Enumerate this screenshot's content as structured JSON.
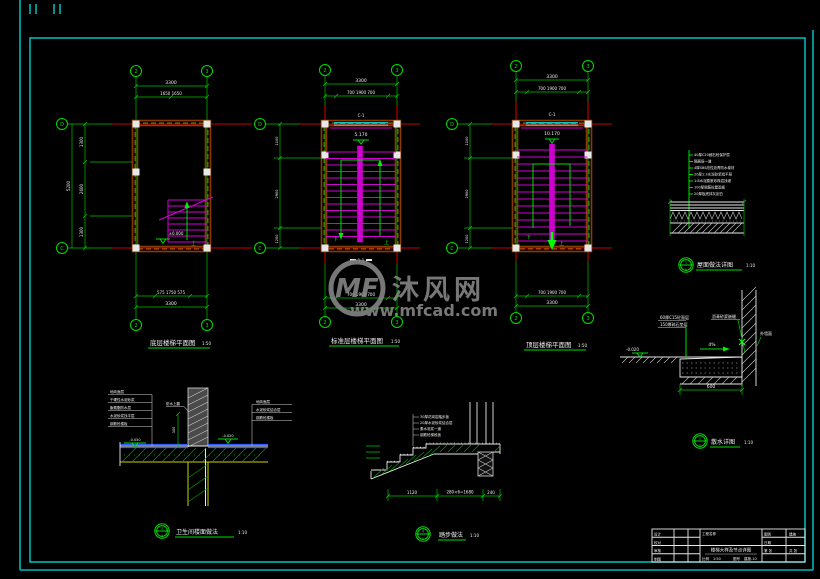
{
  "frame": {
    "border_color": "#00b7b7"
  },
  "watermark": {
    "logo_text": "MF",
    "brand": "沐风网",
    "url": "www.mfcad.com"
  },
  "axis_bubbles": {
    "top": [
      "2",
      "3"
    ],
    "side": [
      "D",
      "C"
    ]
  },
  "plans": [
    {
      "title": "底层楼梯平面图",
      "scale": "1:50",
      "dim_top_1": "3300",
      "dim_top_2": "1650  1650",
      "dim_bottom_1": "575 1750 575",
      "dim_bottom_2": "3300",
      "dim_left": [
        "1300",
        "2600",
        "1300"
      ],
      "dim_left_overall": "5200",
      "elevation": "±0.000",
      "arrow_up": "上"
    },
    {
      "title": "标准层楼梯平面图",
      "scale": "1:50",
      "window": "C-1",
      "elevation": "5.170",
      "dim_top_1": "3300",
      "dim_top_2": "700 1900 700",
      "dim_bottom_1": "700 1900 700",
      "dim_bottom_2": "3300",
      "dim_left": [
        "1100",
        "2900",
        "1200"
      ],
      "arrow_up": "上",
      "arrow_down": "下",
      "section_mark": "1-1"
    },
    {
      "title": "顶层楼梯平面图",
      "scale": "1:50",
      "window": "C-1",
      "elevation": "10.170",
      "dim_top_1": "3300",
      "dim_top_2": "700 1900 700",
      "dim_bottom_1": "700 1900 700",
      "dim_bottom_2": "3300",
      "dim_left": [
        "1100",
        "2900",
        "1200"
      ],
      "arrow_up": "上",
      "arrow_down": "下"
    }
  ],
  "details": [
    {
      "title": "屋面做法详图",
      "scale": "1:10",
      "bubble_top": "1",
      "bubble_bottom": "A",
      "layers": [
        "40厚C20细石砼保护层",
        "隔离层一道",
        "4厚SBS改性沥青防水卷材",
        "20厚1:3水泥砂浆找平层",
        "1:8水泥膨胀珍珠岩找坡",
        "100厚钢筋砼屋面板",
        "20厚板底抹灰刮白"
      ]
    },
    {
      "title": "散水详图",
      "scale": "1:10",
      "bubble_top": "2",
      "bubble_bottom": "A",
      "callout_left_1": "60厚C15砼面层",
      "callout_left_2": "150厚碎石垫层",
      "callout_joint": "沥青砂浆嵌缝",
      "callout_wall": "外墙面",
      "slope": "4%",
      "elevation": "-0.020",
      "dim_width": "600"
    },
    {
      "title": "卫生间楼面做法",
      "scale": "1:10",
      "bubble_top": "3",
      "bubble_bottom": "A",
      "callouts_left": [
        "地砖面层",
        "干硬性水泥砂浆",
        "聚氨酯防水层",
        "水泥砂浆找平层",
        "钢筋砼楼板"
      ],
      "callouts_right": [
        "地砖面层",
        "水泥砂浆结合层",
        "钢筋砼楼板"
      ],
      "callout_upturn": "防水上翻",
      "dim_upturn": "300",
      "elev_left": "-0.050",
      "elev_right": "-0.020"
    },
    {
      "title": "踏步做法",
      "scale": "1:10",
      "bubble_top": "4",
      "bubble_bottom": "A",
      "callouts": [
        "30厚花岗岩踏步板",
        "20厚水泥砂浆结合层",
        "素水泥浆一道",
        "钢筋砼梯段板"
      ],
      "dim_1": "1120",
      "dim_2": "280×6=1680",
      "dim_3": "240"
    }
  ],
  "title_block": {
    "rows": [
      "设计",
      "校对",
      "审核",
      "制图"
    ],
    "project": "工程名称",
    "drawing_title": "楼梯大样及节点详图",
    "scale_label": "比例",
    "scale_value": "1:50",
    "no_label": "图号",
    "no_value": "建施-10",
    "type_label": "图别",
    "type_value": "建施",
    "date_label": "日期",
    "page": "第 张",
    "pages": "共 张"
  }
}
